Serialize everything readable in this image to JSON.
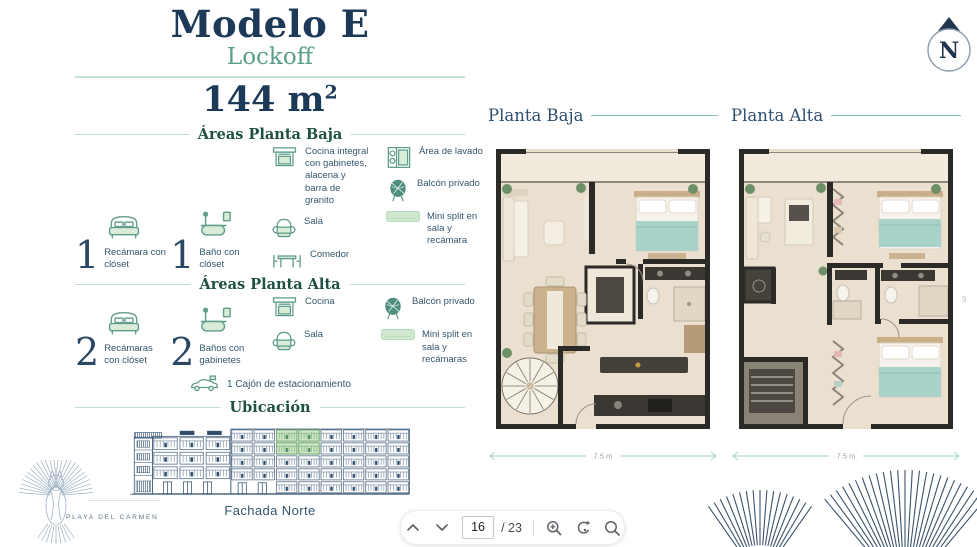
{
  "page": {
    "title": "Modelo E",
    "subtitle": "Lockoff",
    "area_value": "144 m",
    "area_sup": "2"
  },
  "colors": {
    "navy": "#1c3a57",
    "teal": "#5b9d8b",
    "green_line": "#c4e2cd",
    "icon_teal": "#5f9c8c",
    "icon_fill": "#d9ecd8",
    "highlight_green": "#cde7c2"
  },
  "legend_baja": {
    "header": "Áreas Planta Baja",
    "stats": [
      {
        "value": "1",
        "label": "Recámara con clóset",
        "icon": "bed-icon"
      },
      {
        "value": "1",
        "label": "Baño con clóset",
        "icon": "bathtub-icon"
      }
    ],
    "features_left": [
      {
        "icon": "kitchen-icon",
        "label": "Cocina integral con gabinetes, alacena y barra de granito"
      },
      {
        "icon": "armchair-icon",
        "label": "Sala"
      },
      {
        "icon": "dining-table-icon",
        "label": "Comedor"
      }
    ],
    "features_right": [
      {
        "icon": "washer-icon",
        "label": "Área de lavado"
      },
      {
        "icon": "palm-icon",
        "label": "Balcón privado"
      },
      {
        "icon": "minisplit-icon",
        "label": "Mini split en sala y recámara"
      }
    ]
  },
  "legend_alta": {
    "header": "Áreas Planta Alta",
    "stats": [
      {
        "value": "2",
        "label": "Recámaras con clóset",
        "icon": "bed-icon"
      },
      {
        "value": "2",
        "label": "Baños con gabinetes",
        "icon": "bathtub-icon"
      }
    ],
    "features_left": [
      {
        "icon": "kitchen-icon",
        "label": "Cocina"
      },
      {
        "icon": "armchair-icon",
        "label": "Sala"
      }
    ],
    "features_right": [
      {
        "icon": "palm-icon",
        "label": "Balcón privado"
      },
      {
        "icon": "minisplit-icon",
        "label": "Mini split en sala y recámaras"
      }
    ]
  },
  "parking": {
    "label": "1 Cajón de estacionamiento",
    "icon": "car-icon"
  },
  "ubicacion": {
    "header": "Ubicación",
    "caption": "Fachada Norte"
  },
  "plans": {
    "baja": {
      "title": "Planta Baja",
      "dim": "7.5 m"
    },
    "alta": {
      "title": "Planta Alta",
      "dim": "7.5 m",
      "side_dim": "9"
    }
  },
  "compass": {
    "letter": "N"
  },
  "brand": {
    "name": "PLAYA DEL CARMEN"
  },
  "pager": {
    "page": "16",
    "total": "/ 23"
  }
}
